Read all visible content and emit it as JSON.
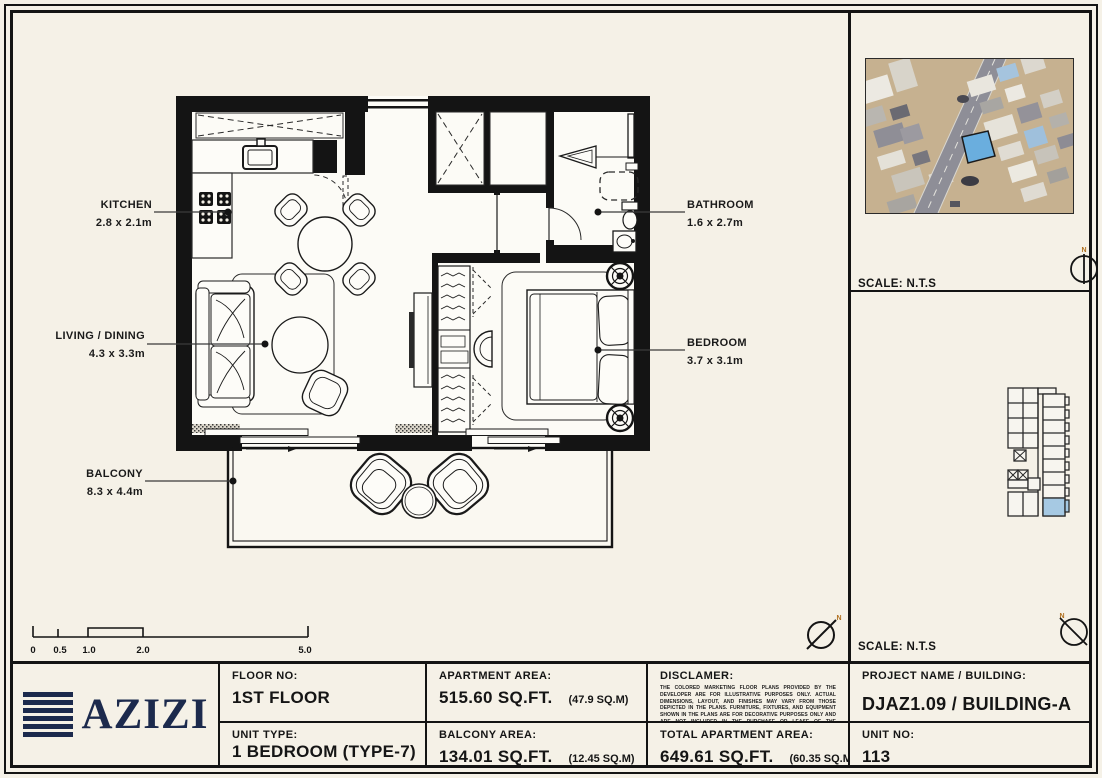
{
  "colors": {
    "paper": "#f5f1e7",
    "ink": "#141414",
    "logo_navy": "#1c2a4d",
    "north_orange": "#b06f1e"
  },
  "plan": {
    "rooms": [
      {
        "name": "KITCHEN",
        "dims": "2.8 x 2.1m"
      },
      {
        "name": "LIVING / DINING",
        "dims": "4.3 x 3.3m"
      },
      {
        "name": "BALCONY",
        "dims": "8.3 x 4.4m"
      },
      {
        "name": "BATHROOM",
        "dims": "1.6 x 2.7m"
      },
      {
        "name": "BEDROOM",
        "dims": "3.7 x 3.1m"
      }
    ],
    "scale_ticks": [
      "0",
      "0.5",
      "1.0",
      "2.0",
      "5.0"
    ],
    "north_label": "N"
  },
  "side_panel": {
    "map_scale_label": "SCALE: N.T.S",
    "keyplan_scale_label": "SCALE: N.T.S",
    "unit_highlight_color": "#a6c9e3",
    "map_plot_color": "#6aaede"
  },
  "title_block": {
    "logo_text": "AZIZI",
    "floor_no": {
      "label": "FLOOR NO:",
      "value": "1ST FLOOR"
    },
    "unit_type": {
      "label": "UNIT TYPE:",
      "value": "1 BEDROOM (TYPE-7)"
    },
    "apartment_area": {
      "label": "APARTMENT AREA:",
      "value": "515.60 SQ.FT.",
      "metric": "(47.9 SQ.M)"
    },
    "balcony_area": {
      "label": "BALCONY AREA:",
      "value": "134.01 SQ.FT.",
      "metric": "(12.45 SQ.M)"
    },
    "disclaimer": {
      "label": "DISCLAMER:",
      "text": "THE COLORED MARKETING FLOOR PLANS PROVIDED BY THE DEVELOPER ARE FOR ILLUSTRATIVE PURPOSES ONLY. ACTUAL DIMENSIONS, LAYOUT, AND FINISHES MAY VARY FROM THOSE DEPICTED IN THE PLANS. FURNITURE, FIXTURES, AND EQUIPMENT SHOWN IN THE PLANS ARE FOR DECORATIVE PURPOSES ONLY AND ARE NOT INCLUDED IN THE PURCHASE OR LEASE OF THE PROPERTY. THE DEVELOPER RESERVES THE RIGHT TO MAKE MODIFICATIONS, REVISIONS, AND CHANGES TO THE FLOOR PLANS, SPECIFICATIONS, AND FEATURES WITHOUT PRIOR NOTICE."
    },
    "total_area": {
      "label": "TOTAL APARTMENT AREA:",
      "value": "649.61 SQ.FT.",
      "metric": "(60.35 SQ.M)"
    },
    "project": {
      "label": "PROJECT NAME / BUILDING:",
      "value": "DJAZ1.09 / BUILDING-A"
    },
    "unit_no": {
      "label": "UNIT NO:",
      "value": "113"
    }
  }
}
